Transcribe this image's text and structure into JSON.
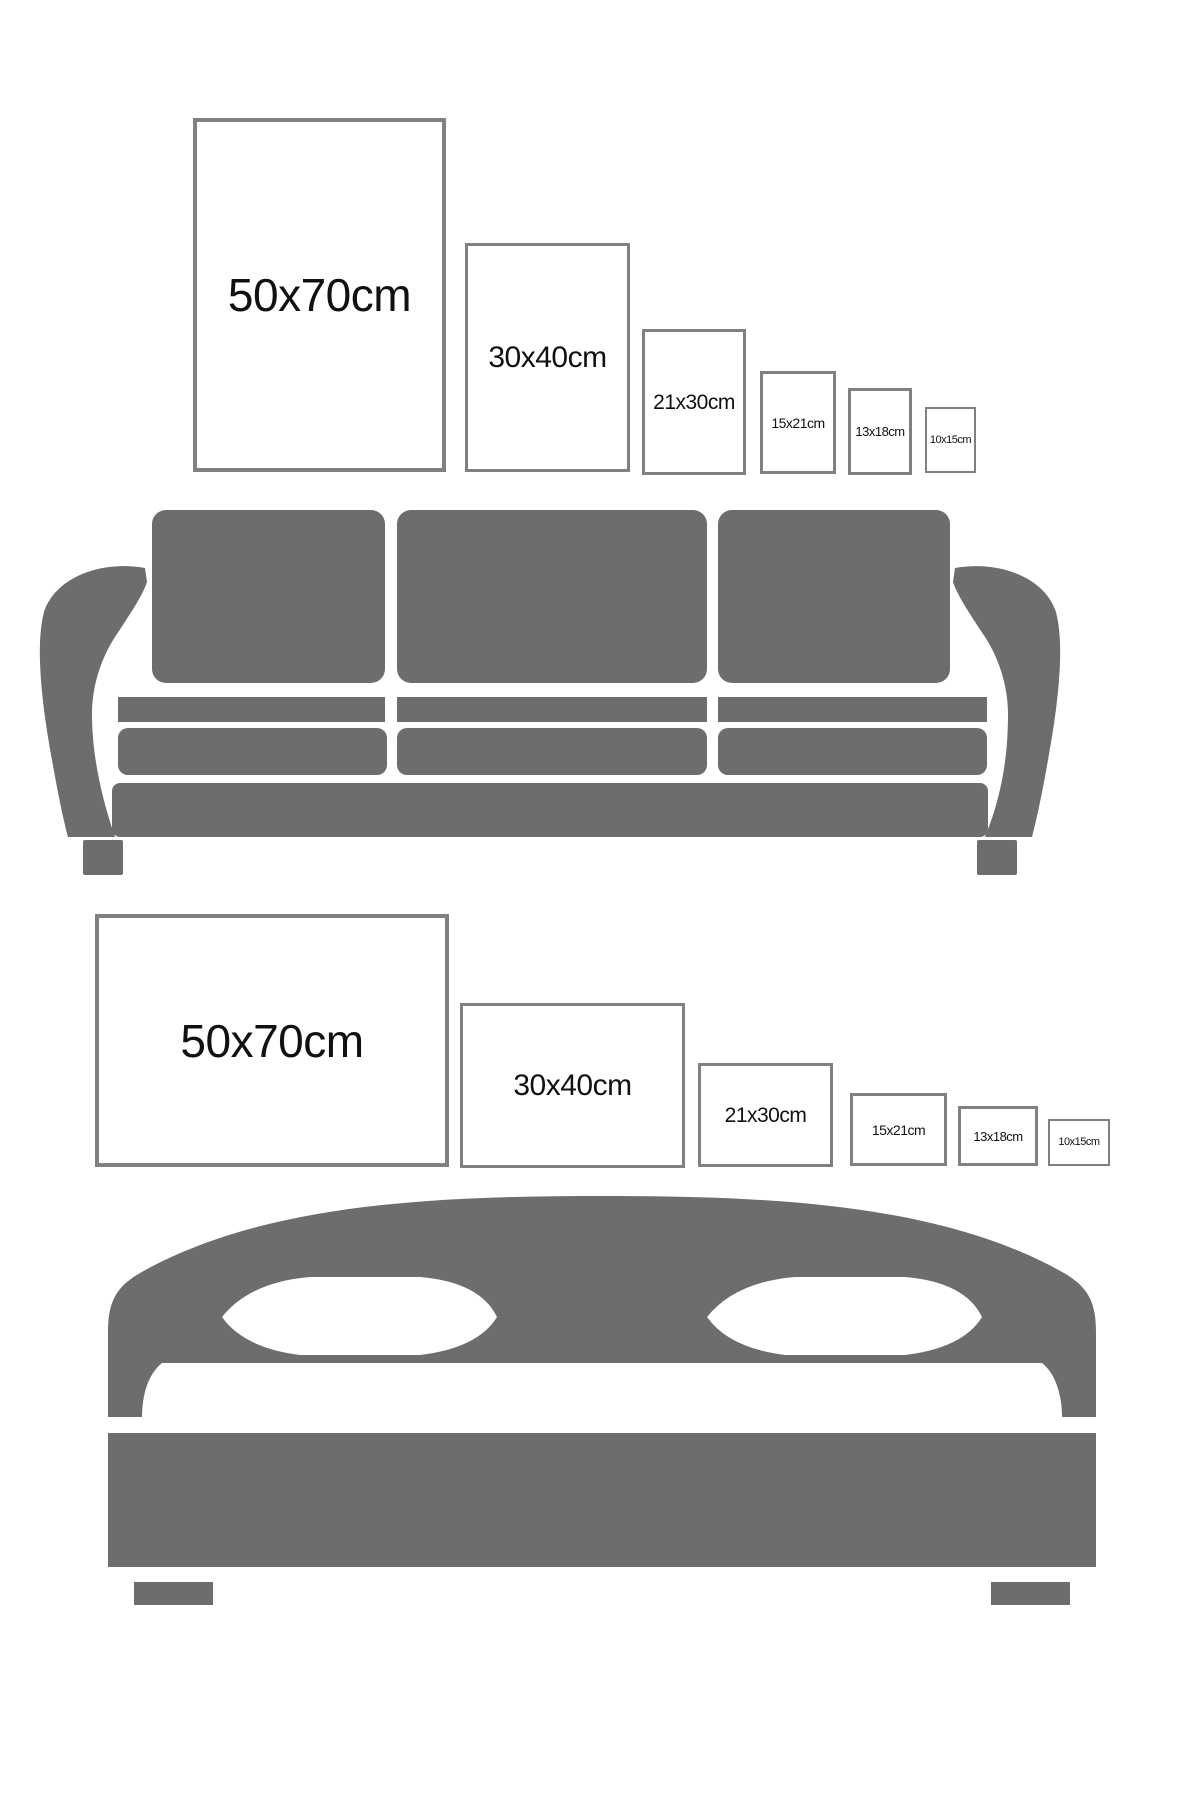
{
  "canvas": {
    "width": 1200,
    "height": 1800,
    "background": "#ffffff"
  },
  "colors": {
    "furniture_gray": "#6d6d6d",
    "frame_border": "#7f7f7f",
    "label_text": "#111111"
  },
  "illustrations": {
    "sofa": "sofa-silhouette",
    "bed": "bed-silhouette"
  },
  "portrait_row": {
    "description": "Portrait frame sizes above sofa",
    "frames": [
      {
        "label": "50x70cm",
        "x": 193,
        "y": 118,
        "w": 253,
        "h": 354,
        "font": 46,
        "border": 4
      },
      {
        "label": "30x40cm",
        "x": 465,
        "y": 243,
        "w": 165,
        "h": 229,
        "font": 30,
        "border": 3
      },
      {
        "label": "21x30cm",
        "x": 642,
        "y": 329,
        "w": 104,
        "h": 146,
        "font": 21,
        "border": 3
      },
      {
        "label": "15x21cm",
        "x": 760,
        "y": 371,
        "w": 76,
        "h": 103,
        "font": 14,
        "border": 3
      },
      {
        "label": "13x18cm",
        "x": 848,
        "y": 388,
        "w": 64,
        "h": 87,
        "font": 13,
        "border": 3
      },
      {
        "label": "10x15cm",
        "x": 925,
        "y": 407,
        "w": 51,
        "h": 66,
        "font": 11,
        "border": 2
      }
    ]
  },
  "landscape_row": {
    "description": "Landscape frame sizes above bed",
    "frames": [
      {
        "label": "50x70cm",
        "x": 95,
        "y": 914,
        "w": 354,
        "h": 253,
        "font": 46,
        "border": 4
      },
      {
        "label": "30x40cm",
        "x": 460,
        "y": 1003,
        "w": 225,
        "h": 165,
        "font": 30,
        "border": 3
      },
      {
        "label": "21x30cm",
        "x": 698,
        "y": 1063,
        "w": 135,
        "h": 104,
        "font": 21,
        "border": 3
      },
      {
        "label": "15x21cm",
        "x": 850,
        "y": 1093,
        "w": 97,
        "h": 73,
        "font": 14,
        "border": 3
      },
      {
        "label": "13x18cm",
        "x": 958,
        "y": 1106,
        "w": 80,
        "h": 60,
        "font": 13,
        "border": 3
      },
      {
        "label": "10x15cm",
        "x": 1048,
        "y": 1119,
        "w": 62,
        "h": 47,
        "font": 11,
        "border": 2
      }
    ]
  }
}
